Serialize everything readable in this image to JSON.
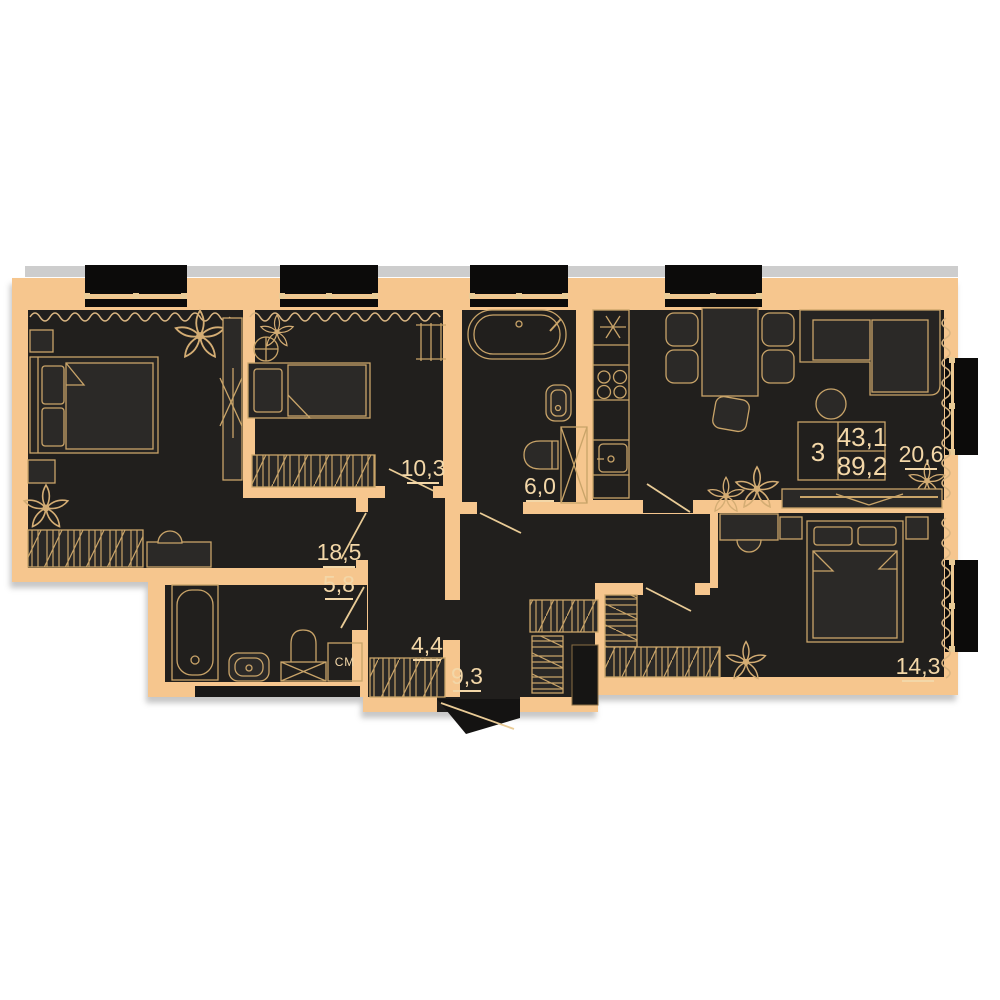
{
  "plan": {
    "summary": {
      "rooms_count": "3",
      "living_area": "43,1",
      "total_area": "89,2"
    },
    "rooms": {
      "living": {
        "name": "living-room",
        "area": "18,5"
      },
      "bedroom2": {
        "name": "bedroom-2",
        "area": "10,3"
      },
      "bathroom_main": {
        "name": "bathroom-main",
        "area": "6,0"
      },
      "kitchen_living": {
        "name": "kitchen-living",
        "area": "20,6"
      },
      "bathroom_small": {
        "name": "bathroom-small",
        "area": "5,8"
      },
      "closet": {
        "name": "closet",
        "area": "4,4"
      },
      "hallway": {
        "name": "hallway",
        "area": "9,3"
      },
      "bedroom3": {
        "name": "bedroom-3",
        "area": "14,3"
      }
    },
    "labels": {
      "washing_machine": "СМ"
    },
    "colors": {
      "wall": "#f6c68e",
      "floor": "#211f1d",
      "furniture": "#2b2927",
      "line": "#c9a469",
      "text": "#f3d7a8",
      "window": "#0c0b0a",
      "shadow": "#cdcdcd"
    }
  }
}
